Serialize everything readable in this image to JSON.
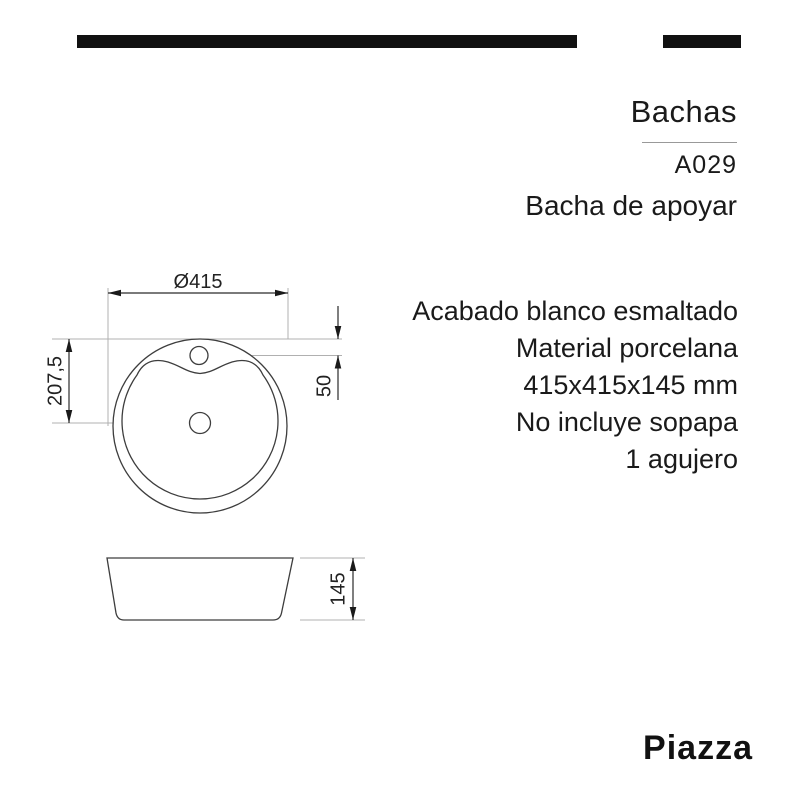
{
  "header": {
    "category": "Bachas",
    "code": "A029",
    "product_name": "Bacha de apoyar"
  },
  "specs": {
    "lines": [
      "Acabado blanco esmaltado",
      "Material porcelana",
      "415x415x145 mm",
      "No incluye sopapa",
      "1 agujero"
    ]
  },
  "drawing": {
    "top_view": {
      "diameter_label": "Ø415",
      "vertical_offset_label": "207,5",
      "faucet_offset_label": "50"
    },
    "side_view": {
      "height_label": "145"
    }
  },
  "brand": {
    "logo": "Piazza"
  },
  "colors": {
    "ink": "#1a1a1a",
    "drawing_line": "#3d3d3d",
    "reference_line": "#b0b0b0",
    "bar": "#111111",
    "divider": "#999999"
  }
}
